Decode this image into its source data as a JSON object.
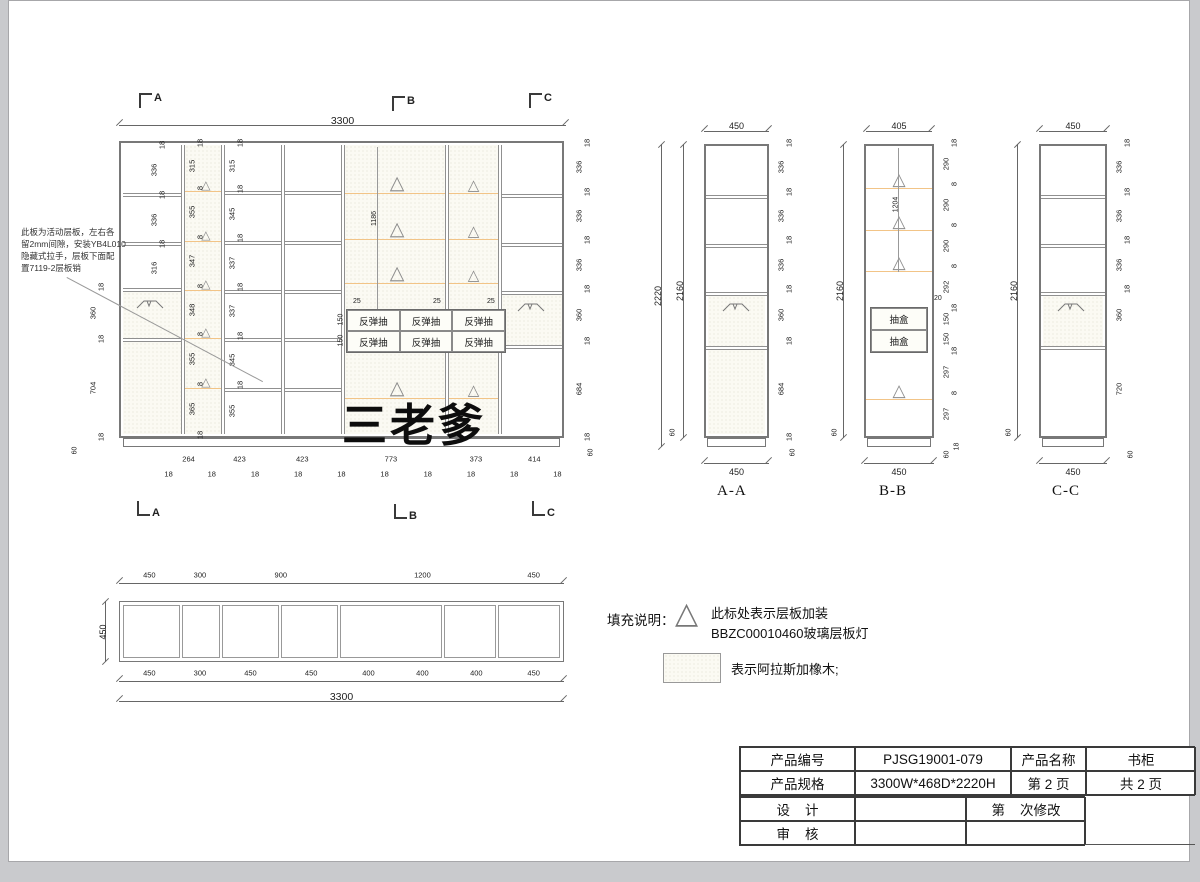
{
  "watermark": "三老爹",
  "note": {
    "lines": [
      "此板为活动层板，左右各",
      "留2mm间隙，安装YB4L010",
      "隐藏式拉手，层板下面配",
      "置7119-2层板销"
    ]
  },
  "elevation": {
    "total_top": "3300",
    "markers": {
      "a": "A",
      "b": "B",
      "c": "C"
    },
    "col1_chain": [
      "18",
      "336",
      "18",
      "336",
      "18",
      "316"
    ],
    "col2_chain": [
      "18",
      "315",
      "8",
      "355",
      "8",
      "347",
      "8",
      "348",
      "8",
      "355",
      "8",
      "365",
      "18"
    ],
    "col3_chain": [
      "18",
      "315",
      "18",
      "345",
      "18",
      "337",
      "18",
      "337",
      "18",
      "345",
      "18",
      "355"
    ],
    "left_chain": [
      "18",
      "360",
      "18",
      "704",
      "18"
    ],
    "left_base": "60",
    "right_chain": [
      "18",
      "336",
      "18",
      "336",
      "18",
      "336",
      "18",
      "360",
      "18",
      "684",
      "18"
    ],
    "right_base": "60",
    "mid_height": "1186",
    "drawer_label": "反弹抽",
    "drawer_top_dims": [
      "25",
      "25",
      "25"
    ],
    "drawer_side_dims": [
      "150",
      "150"
    ],
    "bottom_main": [
      "264",
      "423",
      "423",
      "773",
      "373",
      "414"
    ],
    "bottom_minor": [
      "18",
      "18",
      "18",
      "18",
      "18",
      "18",
      "18",
      "18",
      "18",
      "18"
    ]
  },
  "section_aa": {
    "label": "A-A",
    "top": "450",
    "bottom": "450",
    "h_outer": "2220",
    "h_inner": "2160",
    "base": "60",
    "right_chain": [
      "18",
      "336",
      "18",
      "336",
      "18",
      "336",
      "18",
      "360",
      "18",
      "684",
      "18"
    ],
    "right_base": "60"
  },
  "section_bb": {
    "label": "B-B",
    "top": "405",
    "bottom": "450",
    "h_inner": "2160",
    "base": "60",
    "mid_height": "1204",
    "drawer_label": "抽盒",
    "notch": "20",
    "right_chain": [
      "18",
      "290",
      "8",
      "290",
      "8",
      "290",
      "8",
      "292",
      "18",
      "150",
      "150",
      "18",
      "297",
      "8",
      "297"
    ],
    "right_18": "18",
    "right_base": "60"
  },
  "section_cc": {
    "label": "C-C",
    "top": "450",
    "bottom": "450",
    "h_inner": "2160",
    "base": "60",
    "right_chain": [
      "18",
      "336",
      "18",
      "336",
      "18",
      "336",
      "18",
      "360",
      "720"
    ],
    "right_base": "60"
  },
  "plan": {
    "top_dims": [
      "450",
      "300",
      "900",
      "1200",
      "450"
    ],
    "left": "450",
    "bottom_dims": [
      "450",
      "300",
      "450",
      "450",
      "400",
      "400",
      "400",
      "450"
    ],
    "total": "3300"
  },
  "legend": {
    "title": "填充说明：",
    "item1_line1": "此标处表示层板加装",
    "item1_line2": "BBZC00010460玻璃层板灯",
    "item2": "表示阿拉斯加橡木;"
  },
  "titleblock": {
    "r1c1": "产品编号",
    "r1c2": "PJSG19001-079",
    "r1c3": "产品名称",
    "r1c4": "书柜",
    "r2c1": "产品规格",
    "r2c2": "3300W*468D*2220H",
    "r2c3": "第 2 页",
    "r2c4": "共 2 页",
    "r3c1": "设    计",
    "r3c2": "",
    "r3c3": "第    次修改",
    "r4c1": "审    核",
    "r4c2": "",
    "r4c3": ""
  }
}
